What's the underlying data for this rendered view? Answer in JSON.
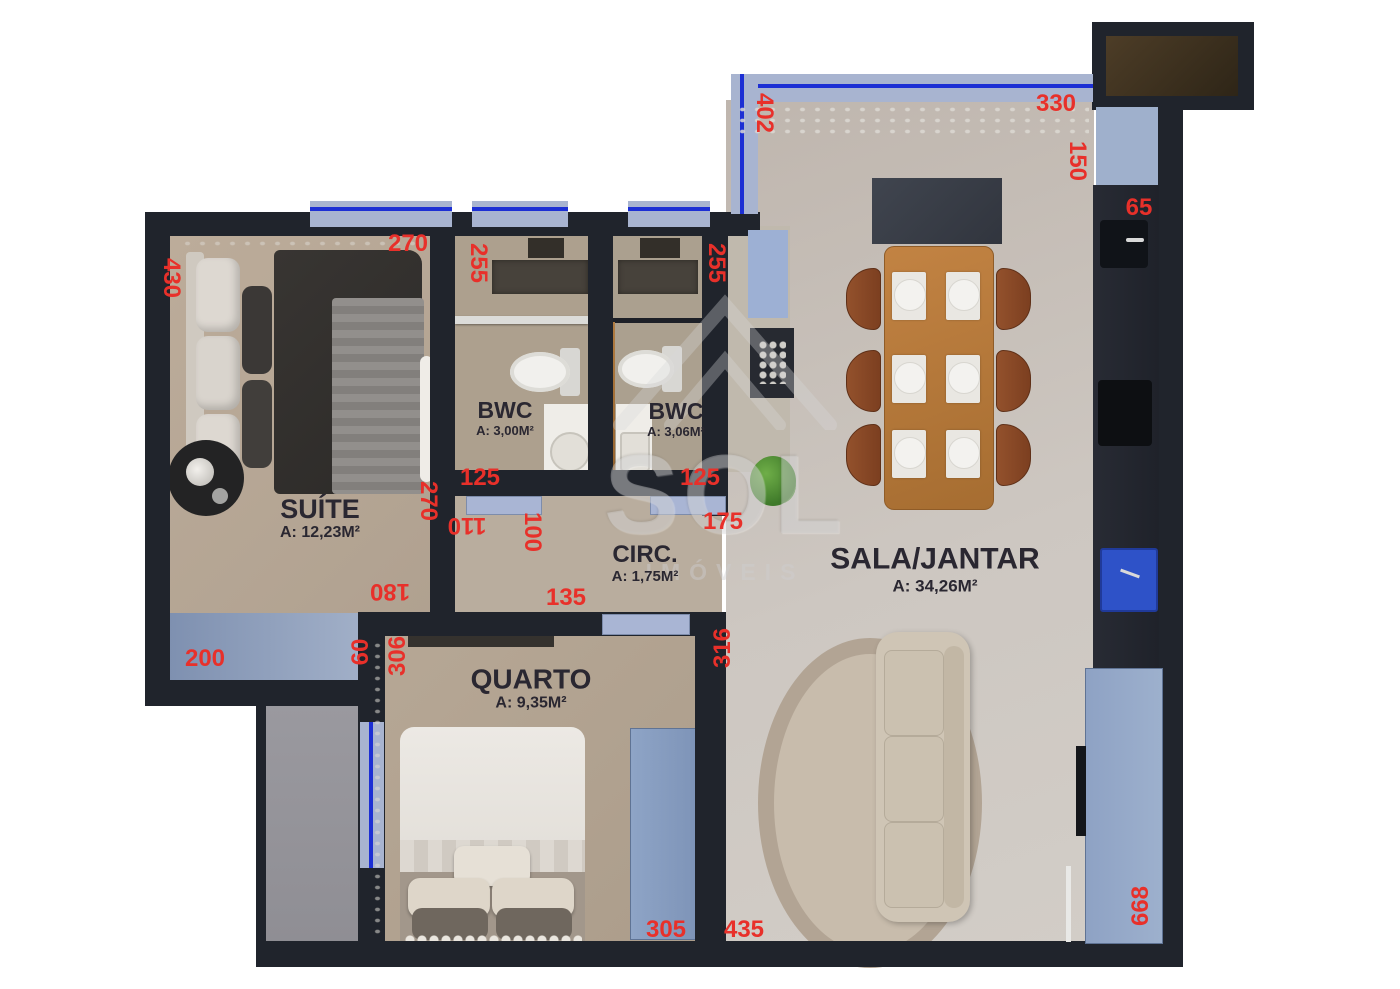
{
  "watermark": {
    "brand": "SOL",
    "subtitle": "IMÓVEIS"
  },
  "rooms": [
    {
      "id": "suite",
      "name": "SUÍTE",
      "area": "A: 12,23M²"
    },
    {
      "id": "bwc-left",
      "name": "BWC",
      "area": "A: 3,00M²"
    },
    {
      "id": "bwc-right",
      "name": "BWC",
      "area": "A: 3,06M²"
    },
    {
      "id": "circulacao",
      "name": "CIRC.",
      "area": "A: 1,75M²"
    },
    {
      "id": "quarto",
      "name": "QUARTO",
      "area": "A: 9,35M²"
    },
    {
      "id": "sala-jantar",
      "name": "SALA/JANTAR",
      "area": "A: 34,26M²"
    }
  ],
  "dimensions": [
    {
      "value": "430",
      "x": 171,
      "y": 278,
      "rot": 90
    },
    {
      "value": "270",
      "x": 408,
      "y": 244,
      "rot": 0
    },
    {
      "value": "255",
      "x": 478,
      "y": 263,
      "rot": 90
    },
    {
      "value": "255",
      "x": 716,
      "y": 263,
      "rot": 90
    },
    {
      "value": "402",
      "x": 764,
      "y": 113,
      "rot": 90
    },
    {
      "value": "330",
      "x": 1056,
      "y": 104,
      "rot": 0
    },
    {
      "value": "150",
      "x": 1077,
      "y": 161,
      "rot": 90
    },
    {
      "value": "65",
      "x": 1139,
      "y": 208,
      "rot": 0
    },
    {
      "value": "125",
      "x": 480,
      "y": 478,
      "rot": 0
    },
    {
      "value": "270",
      "x": 428,
      "y": 501,
      "rot": 90
    },
    {
      "value": "110",
      "x": 467,
      "y": 525,
      "rot": 180
    },
    {
      "value": "100",
      "x": 532,
      "y": 532,
      "rot": 90
    },
    {
      "value": "125",
      "x": 700,
      "y": 478,
      "rot": 0
    },
    {
      "value": "175",
      "x": 723,
      "y": 522,
      "rot": 0
    },
    {
      "value": "135",
      "x": 566,
      "y": 598,
      "rot": 0
    },
    {
      "value": "180",
      "x": 390,
      "y": 591,
      "rot": 180
    },
    {
      "value": "200",
      "x": 205,
      "y": 659,
      "rot": 0
    },
    {
      "value": "60",
      "x": 361,
      "y": 652,
      "rot": -90
    },
    {
      "value": "306",
      "x": 398,
      "y": 656,
      "rot": -90
    },
    {
      "value": "316",
      "x": 723,
      "y": 648,
      "rot": -90
    },
    {
      "value": "305",
      "x": 666,
      "y": 930,
      "rot": 0
    },
    {
      "value": "435",
      "x": 744,
      "y": 930,
      "rot": 0
    },
    {
      "value": "668",
      "x": 1141,
      "y": 906,
      "rot": -90
    }
  ],
  "colors": {
    "wall": "#20242c",
    "dimension_text": "#e8302a",
    "glass": "#a8b4d0",
    "glass_line": "#1c2fd4",
    "suite_floor": "#b7a896",
    "sala_floor": "#c6c0b9",
    "wood_table": "#b5793c"
  }
}
